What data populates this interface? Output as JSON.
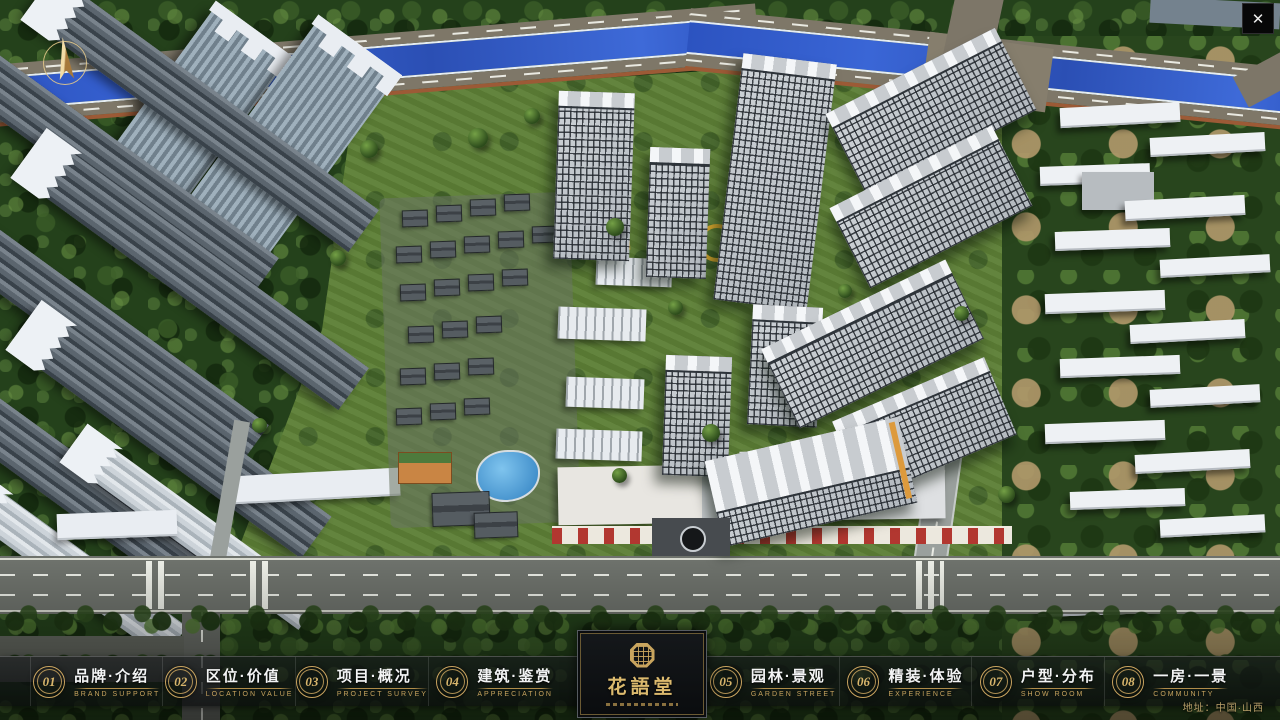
{
  "window": {
    "close_glyph": "✕"
  },
  "nav": {
    "items": [
      {
        "number": "01",
        "label": "品牌·介绍",
        "sublabel": "BRAND SUPPORT"
      },
      {
        "number": "02",
        "label": "区位·价值",
        "sublabel": "LOCATION VALUE"
      },
      {
        "number": "03",
        "label": "项目·概况",
        "sublabel": "PROJECT SURVEY"
      },
      {
        "number": "04",
        "label": "建筑·鉴赏",
        "sublabel": "APPRECIATION"
      },
      {
        "number": "05",
        "label": "园林·景观",
        "sublabel": "GARDEN STREET"
      },
      {
        "number": "06",
        "label": "精装·体验",
        "sublabel": "EXPERIENCE"
      },
      {
        "number": "07",
        "label": "户型·分布",
        "sublabel": "SHOW ROOM"
      },
      {
        "number": "08",
        "label": "一房·一景",
        "sublabel": "COMMUNITY"
      }
    ]
  },
  "logo": {
    "title": "花語堂"
  },
  "footer": {
    "address": "地址：中国·山西"
  },
  "colors": {
    "gold": "#c9a55e",
    "river": "#2f55c4",
    "band_bg": "rgba(10,12,14,0.65)"
  }
}
